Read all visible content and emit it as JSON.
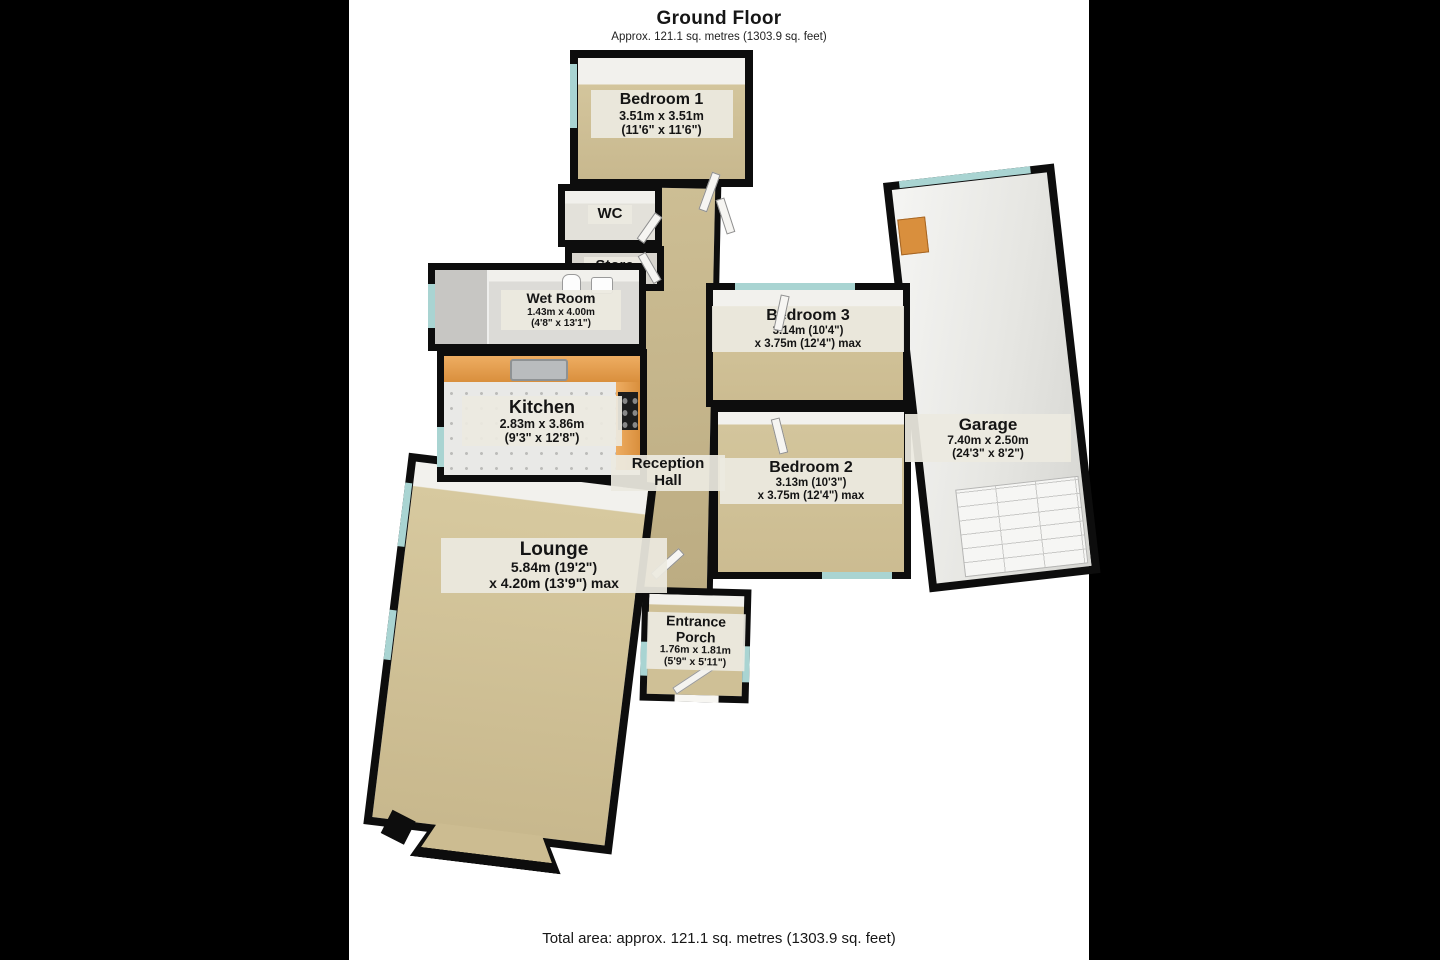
{
  "header": {
    "title": "Ground Floor",
    "subtitle": "Approx. 121.1 sq. metres (1303.9 sq. feet)"
  },
  "footer": {
    "total_area": "Total area: approx. 121.1 sq. metres (1303.9 sq. feet)"
  },
  "colors": {
    "letterbox": "#000000",
    "photo_background": "#ffffff",
    "wall": "#0d0d0d",
    "carpet_floor": "#cdbd92",
    "hard_floor": "#e9e9e7",
    "kitchen_counter": "#d98f3d",
    "window_glass": "#a9d4d2",
    "label_background": "#ebe8df",
    "label_text": "#141414"
  },
  "rooms": [
    {
      "id": "bedroom-1",
      "name": "Bedroom 1",
      "size1": "3.51m x 3.51m",
      "size2": "(11'6\" x 11'6\")"
    },
    {
      "id": "wc",
      "name": "WC"
    },
    {
      "id": "store",
      "name": "Store"
    },
    {
      "id": "wet-room",
      "name": "Wet Room",
      "size1": "1.43m x 4.00m",
      "size2": "(4'8\" x 13'1\")"
    },
    {
      "id": "kitchen",
      "name": "Kitchen",
      "size1": "2.83m x 3.86m",
      "size2": "(9'3\" x 12'8\")"
    },
    {
      "id": "reception-hall",
      "name": "Reception Hall"
    },
    {
      "id": "bedroom-3",
      "name": "Bedroom 3",
      "size1": "3.14m (10'4\")",
      "size2": "x 3.75m (12'4\") max"
    },
    {
      "id": "bedroom-2",
      "name": "Bedroom 2",
      "size1": "3.13m (10'3\")",
      "size2": "x 3.75m (12'4\") max"
    },
    {
      "id": "garage",
      "name": "Garage",
      "size1": "7.40m x 2.50m",
      "size2": "(24'3\" x 8'2\")"
    },
    {
      "id": "lounge",
      "name": "Lounge",
      "size1": "5.84m (19'2\")",
      "size2": "x 4.20m (13'9\") max"
    },
    {
      "id": "entrance-porch",
      "name": "Entrance Porch",
      "size1": "1.76m x 1.81m",
      "size2": "(5'9\" x 5'11\")"
    }
  ],
  "features": [
    "window-icon",
    "door-icon",
    "toilet-icon",
    "basin-icon",
    "kitchen-sink-icon",
    "hob-icon",
    "kitchen-counter",
    "shower-area",
    "garage-door-icon",
    "workbench-icon",
    "bay-window"
  ]
}
